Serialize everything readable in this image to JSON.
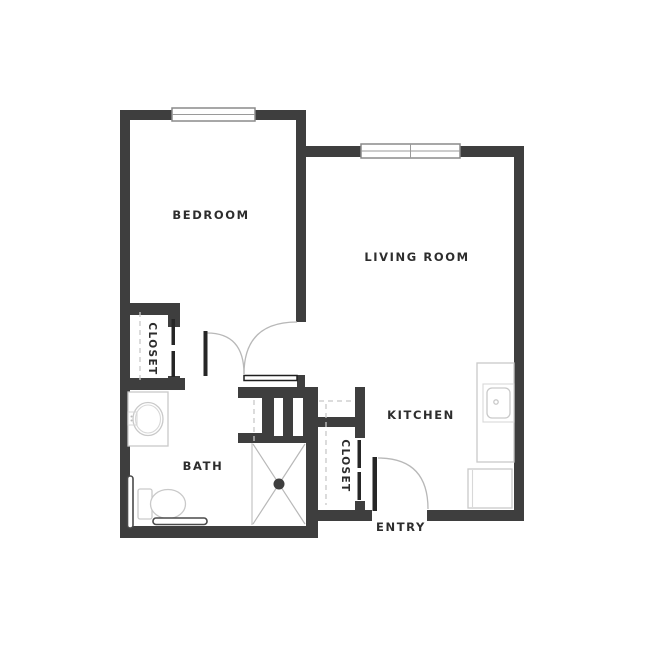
{
  "document": {
    "type": "apartment-floor-plan",
    "background": "#ffffff"
  },
  "colors": {
    "wall": "#3e3e3e",
    "label_text": "#2d2d2d",
    "door_swing_arc": "#b8b8b8",
    "fixture_outline": "#c9c9c9",
    "dashed_line": "#c8c8c8"
  },
  "rooms": {
    "bedroom": {
      "label": "BEDROOM"
    },
    "living_room": {
      "label": "LIVING ROOM"
    },
    "kitchen": {
      "label": "KITCHEN"
    },
    "bath": {
      "label": "BATH"
    },
    "entry": {
      "label": "ENTRY"
    },
    "bedroom_closet": {
      "label": "CLOSET"
    },
    "entry_closet": {
      "label": "CLOSET"
    }
  },
  "openings": {
    "windows": [
      {
        "name": "bedroom-window",
        "wall": "top"
      },
      {
        "name": "living-room-window",
        "wall": "top",
        "panes": 2
      }
    ],
    "doors": [
      {
        "name": "bedroom-door",
        "type": "swing"
      },
      {
        "name": "bath-door",
        "type": "swing"
      },
      {
        "name": "entry-door",
        "type": "swing"
      },
      {
        "name": "bedroom-closet-door",
        "type": "sliding"
      },
      {
        "name": "entry-closet-door",
        "type": "sliding"
      }
    ]
  },
  "fixtures": [
    "bath-vanity-sink",
    "toilet",
    "grab-bar-vertical",
    "grab-bar-horizontal",
    "shower-with-drain",
    "kitchen-counter",
    "kitchen-sink",
    "refrigerator"
  ]
}
